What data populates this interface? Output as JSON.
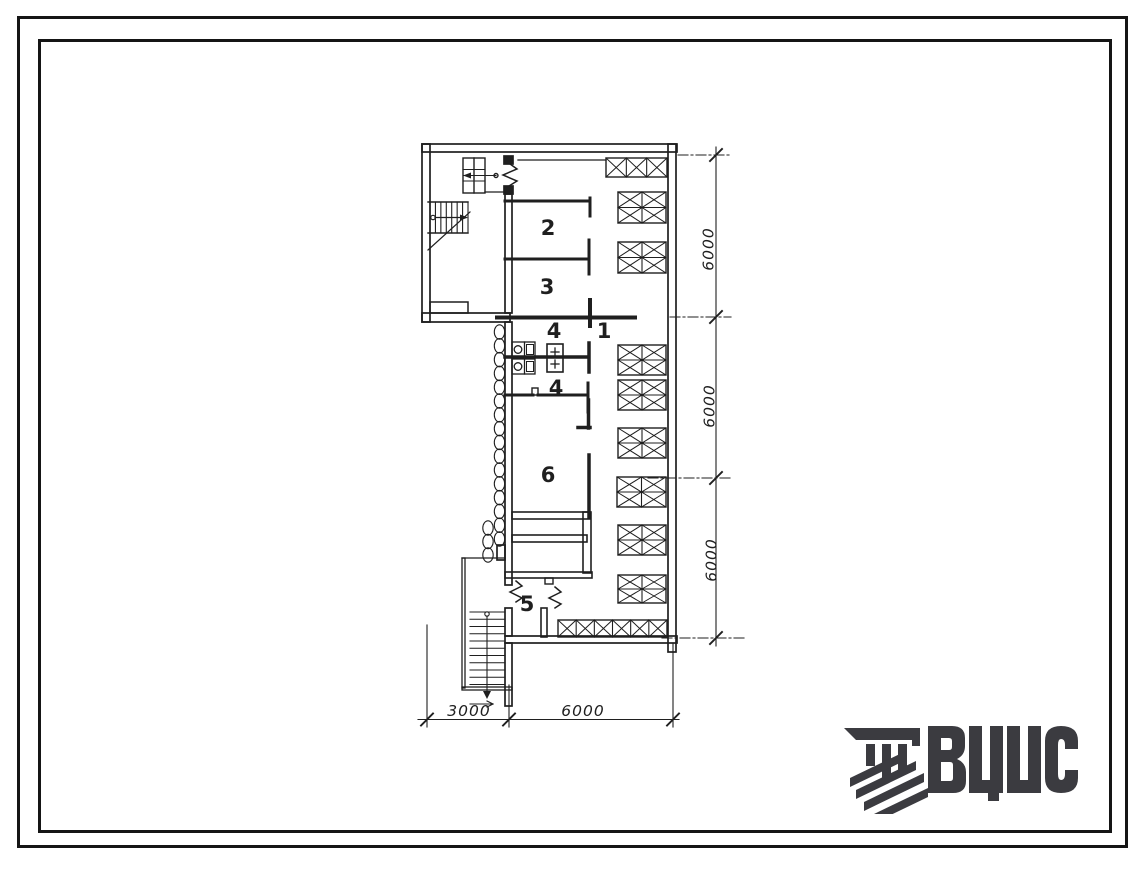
{
  "sheet": {
    "kind": "architectural floor plan drawing"
  },
  "plan": {
    "rooms": [
      {
        "label": "2"
      },
      {
        "label": "3"
      },
      {
        "label": "4"
      },
      {
        "label": "1"
      },
      {
        "label": "4"
      },
      {
        "label": "6"
      },
      {
        "label": "5"
      }
    ],
    "dims_right": [
      {
        "value": "6000"
      },
      {
        "value": "6000"
      },
      {
        "value": "6000"
      }
    ],
    "dims_bottom": [
      {
        "value": "3000"
      },
      {
        "value": "6000"
      }
    ]
  },
  "logo": {
    "text": "ВЦИС",
    "color": "#3b3b40"
  },
  "colors": {
    "ink": "#1f1f1f",
    "paper": "#ffffff"
  }
}
